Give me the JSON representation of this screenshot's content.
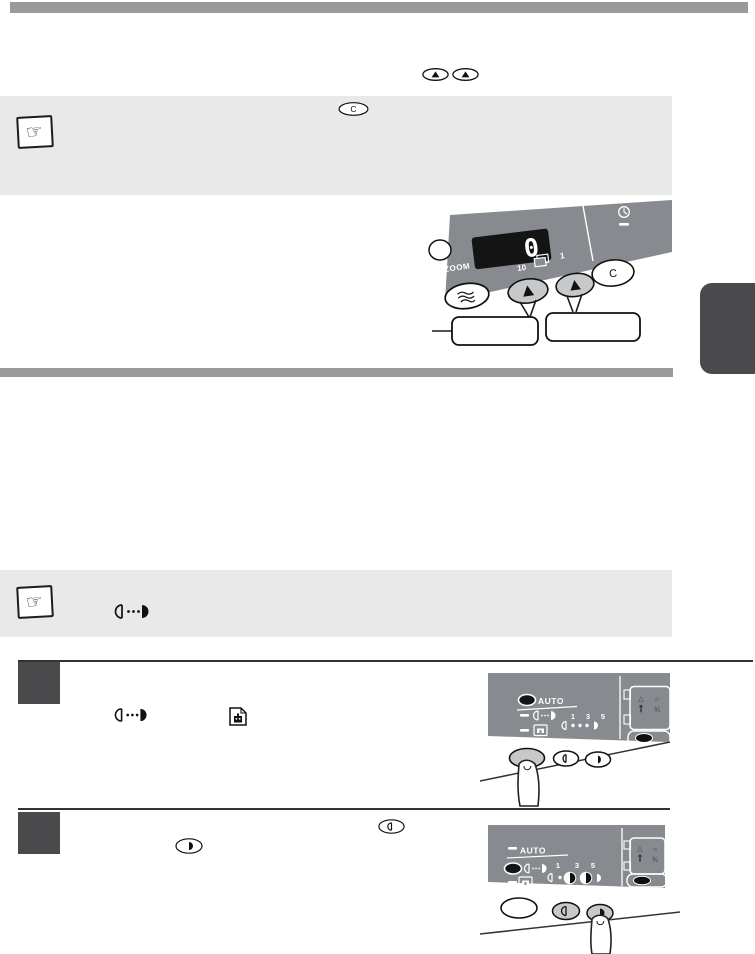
{
  "colors": {
    "bar_gray": "#9a9a9a",
    "note_bg": "#e9e9e9",
    "dark_block": "#4a4a4c",
    "panel_gray": "#878b8f",
    "key_gray": "#c6c8ca",
    "display_bg": "#141414",
    "ink": "#111111",
    "white": "#ffffff"
  },
  "icons": {
    "note_hand": "☞",
    "up_key": "▲",
    "lighten": "left-half-circle-outline",
    "darken": "right-half-circle-filled",
    "exposure_manual": "half-circle-dots-half-circle",
    "photo_mode": "page-with-image",
    "interrupt_wave": "three-wavy-lines",
    "energy_save": "clock-dial"
  },
  "inline_keys": {
    "clear": "C"
  },
  "illustration_quantity": {
    "display_value": "0",
    "zoom_label": "ZOOM",
    "tens_label": "10",
    "units_label": "1",
    "clear_key_label": "C",
    "callout_left": "",
    "callout_right": ""
  },
  "exposure_panel_step1": {
    "auto_label": "AUTO",
    "scale_1": "1",
    "scale_3": "3",
    "scale_5": "5",
    "fraction_label": "¾"
  },
  "exposure_panel_step2": {
    "auto_label": "AUTO",
    "scale_1": "1",
    "scale_3": "3",
    "scale_5": "5",
    "fraction_label": "¾"
  }
}
